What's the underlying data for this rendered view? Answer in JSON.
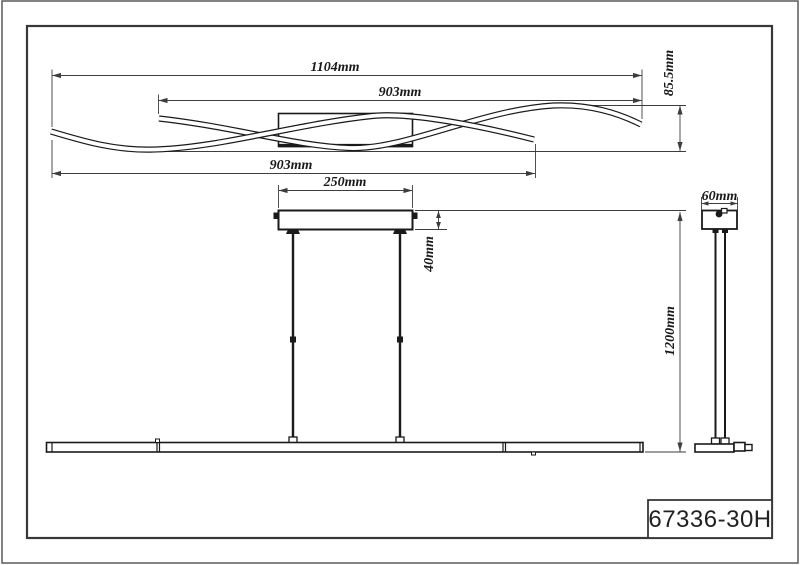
{
  "drawing": {
    "type": "technical-dimension-drawing",
    "product": "pendant-light-with-two-wave-bars",
    "title_block": {
      "model": "67336-30H"
    },
    "dimensions": {
      "overall_width": "1104mm",
      "upper_wave_length": "903mm",
      "wave_depth": "85.5mm",
      "lower_wave_length": "903mm",
      "canopy_width": "250mm",
      "canopy_height": "40mm",
      "hanging_height": "1200mm",
      "canopy_depth": "60mm"
    }
  },
  "colors": {
    "line": "#1a1a1a",
    "dim": "#3d3d3d",
    "frame": "#383838",
    "outer": "#5a5a5a",
    "background": "#ffffff"
  }
}
